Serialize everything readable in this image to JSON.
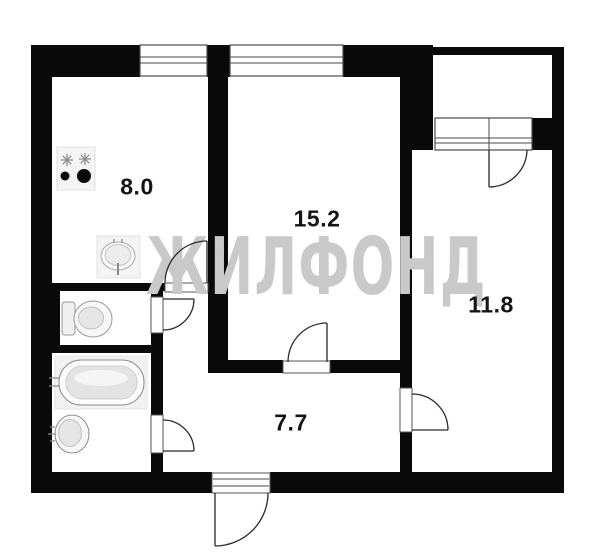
{
  "title": "apartment-floor-plan",
  "watermark": {
    "text": "ЖИЛФОНД",
    "color": "#c9c9c9"
  },
  "rooms": {
    "kitchen": {
      "area": "8.0"
    },
    "living": {
      "area": "15.2"
    },
    "bedroom": {
      "area": "11.8"
    },
    "hallway": {
      "area": "7.7"
    }
  },
  "fixtures": [
    "stove",
    "kitchen-sink",
    "toilet",
    "bathtub",
    "bathroom-sink"
  ],
  "colors": {
    "wall": "#0a0a0a",
    "background": "#ffffff",
    "line_art": "#2a2a2a",
    "watermark": "#c9c9c9",
    "fixture_fill": "#f2f2f2",
    "label_text": "#141414"
  }
}
